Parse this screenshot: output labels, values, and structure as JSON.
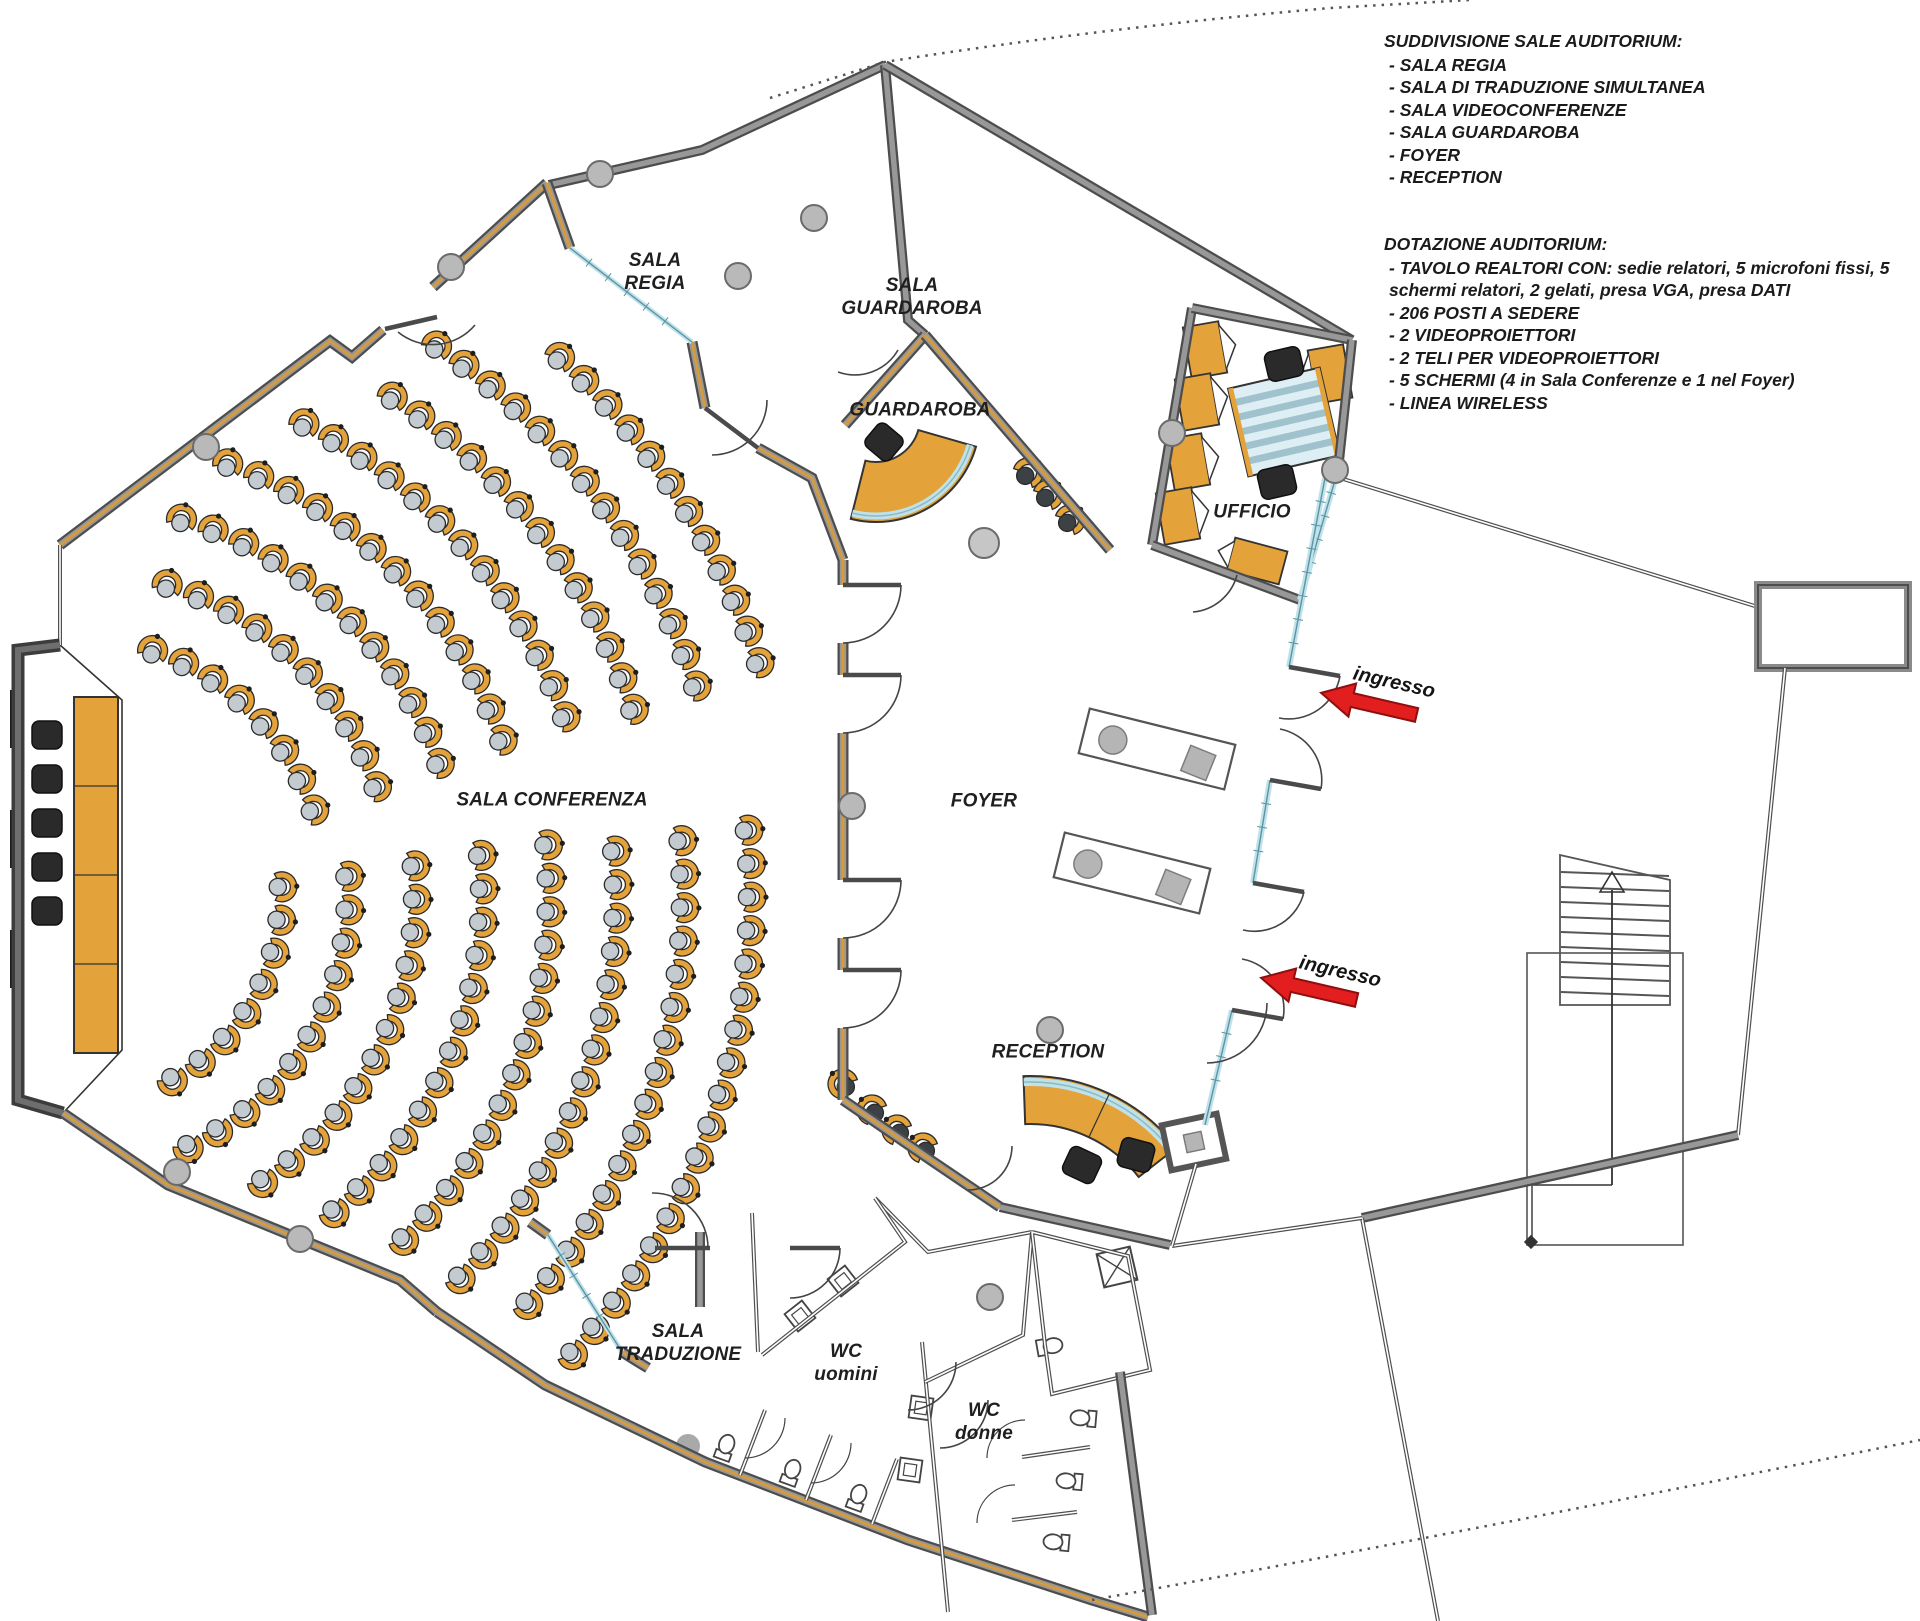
{
  "annotations": {
    "block1": {
      "heading": "SUDDIVISIONE SALE AUDITORIUM:",
      "items": [
        "- SALA REGIA",
        "- SALA DI TRADUZIONE SIMULTANEA",
        "- SALA VIDEOCONFERENZE",
        "- SALA GUARDAROBA",
        "- FOYER",
        "- RECEPTION"
      ]
    },
    "block2": {
      "heading": "DOTAZIONE AUDITORIUM:",
      "items": [
        "- TAVOLO REALTORI CON: sedie relatori, 5 microfoni fissi, 5 schermi relatori, 2 gelati, presa VGA, presa DATI",
        "- 206 POSTI A SEDERE",
        "- 2 VIDEOPROIETTORI",
        "- 2 TELI PER VIDEOPROIETTORI",
        "- 5 SCHERMI (4 in Sala Conferenze e 1 nel Foyer)",
        "- LINEA WIRELESS"
      ]
    }
  },
  "rooms": [
    {
      "id": "sala-regia",
      "label": "SALA\nREGIA",
      "x": 655,
      "y": 272
    },
    {
      "id": "sala-guardaroba",
      "label": "SALA\nGUARDAROBA",
      "x": 912,
      "y": 297
    },
    {
      "id": "guardaroba",
      "label": "GUARDAROBA",
      "x": 920,
      "y": 410
    },
    {
      "id": "ufficio",
      "label": "UFFICIO",
      "x": 1252,
      "y": 512
    },
    {
      "id": "foyer",
      "label": "FOYER",
      "x": 984,
      "y": 801
    },
    {
      "id": "sala-conferenza",
      "label": "SALA CONFERENZA",
      "x": 552,
      "y": 800
    },
    {
      "id": "reception",
      "label": "RECEPTION",
      "x": 1048,
      "y": 1052
    },
    {
      "id": "sala-traduzione",
      "label": "SALA\nTRADUZIONE",
      "x": 678,
      "y": 1343
    },
    {
      "id": "wc-uomini",
      "label": "WC\nuomini",
      "x": 846,
      "y": 1363
    },
    {
      "id": "wc-donne",
      "label": "WC\ndonne",
      "x": 984,
      "y": 1422
    }
  ],
  "entrances": [
    {
      "label": "ingresso",
      "x": 1394,
      "y": 683,
      "tipx": 1322,
      "tipy": 689
    },
    {
      "label": "ingresso",
      "x": 1340,
      "y": 972,
      "tipx": 1262,
      "tipy": 974
    }
  ],
  "colors": {
    "wall_dark": "#4d4d4d",
    "wall_gray": "#989898",
    "wood_orange": "#D79B3C",
    "furniture_orange": "#E4A23B",
    "seat_gray": "#c3cad0",
    "glass_teal": "#bfe2ea",
    "glass_edge": "#5d93a3",
    "column_gray": "#b9b9b9",
    "arrow_red": "#E31E1E",
    "text_dark": "#1f1f1f"
  }
}
